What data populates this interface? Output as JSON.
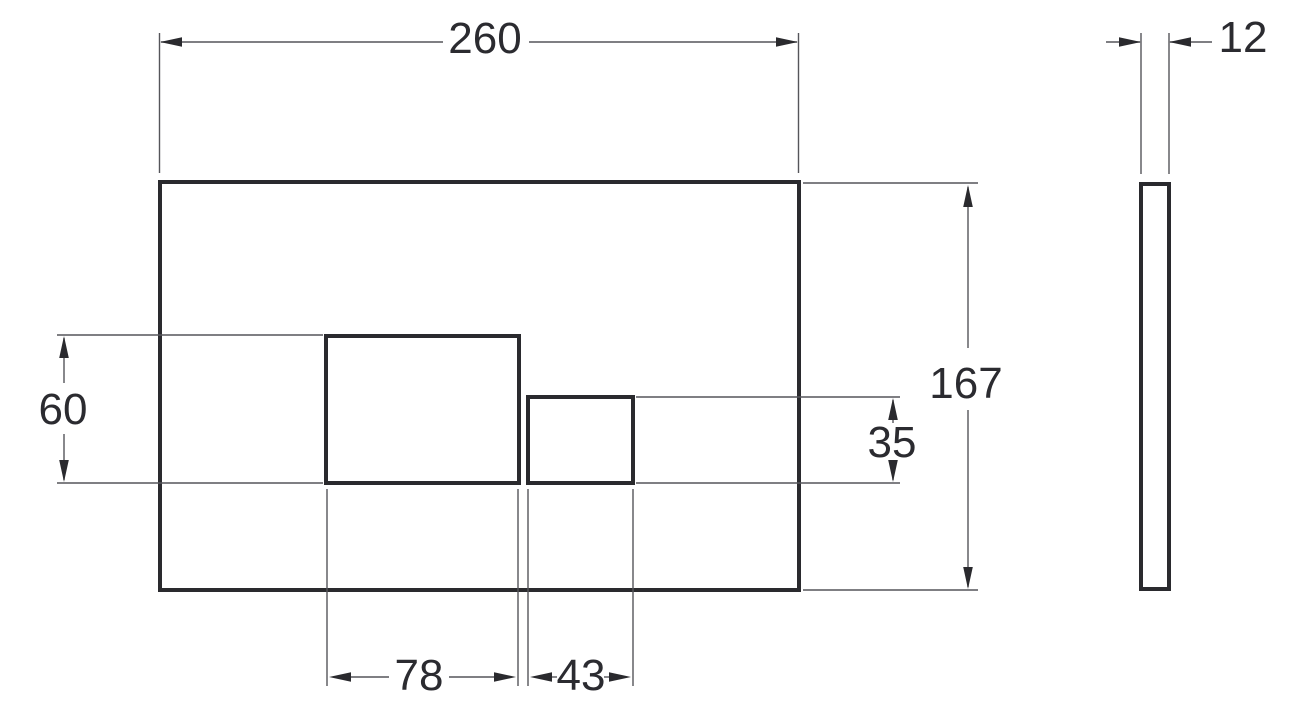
{
  "dimensions": {
    "plate_width": "260",
    "plate_height": "167",
    "plate_thickness": "12",
    "large_button_height": "60",
    "small_button_height": "35",
    "large_button_width": "78",
    "small_button_width": "43"
  },
  "colors": {
    "background": "#ffffff",
    "object_line": "#2a2a2e",
    "dimension_line": "#55555a",
    "text": "#2b2b30"
  }
}
